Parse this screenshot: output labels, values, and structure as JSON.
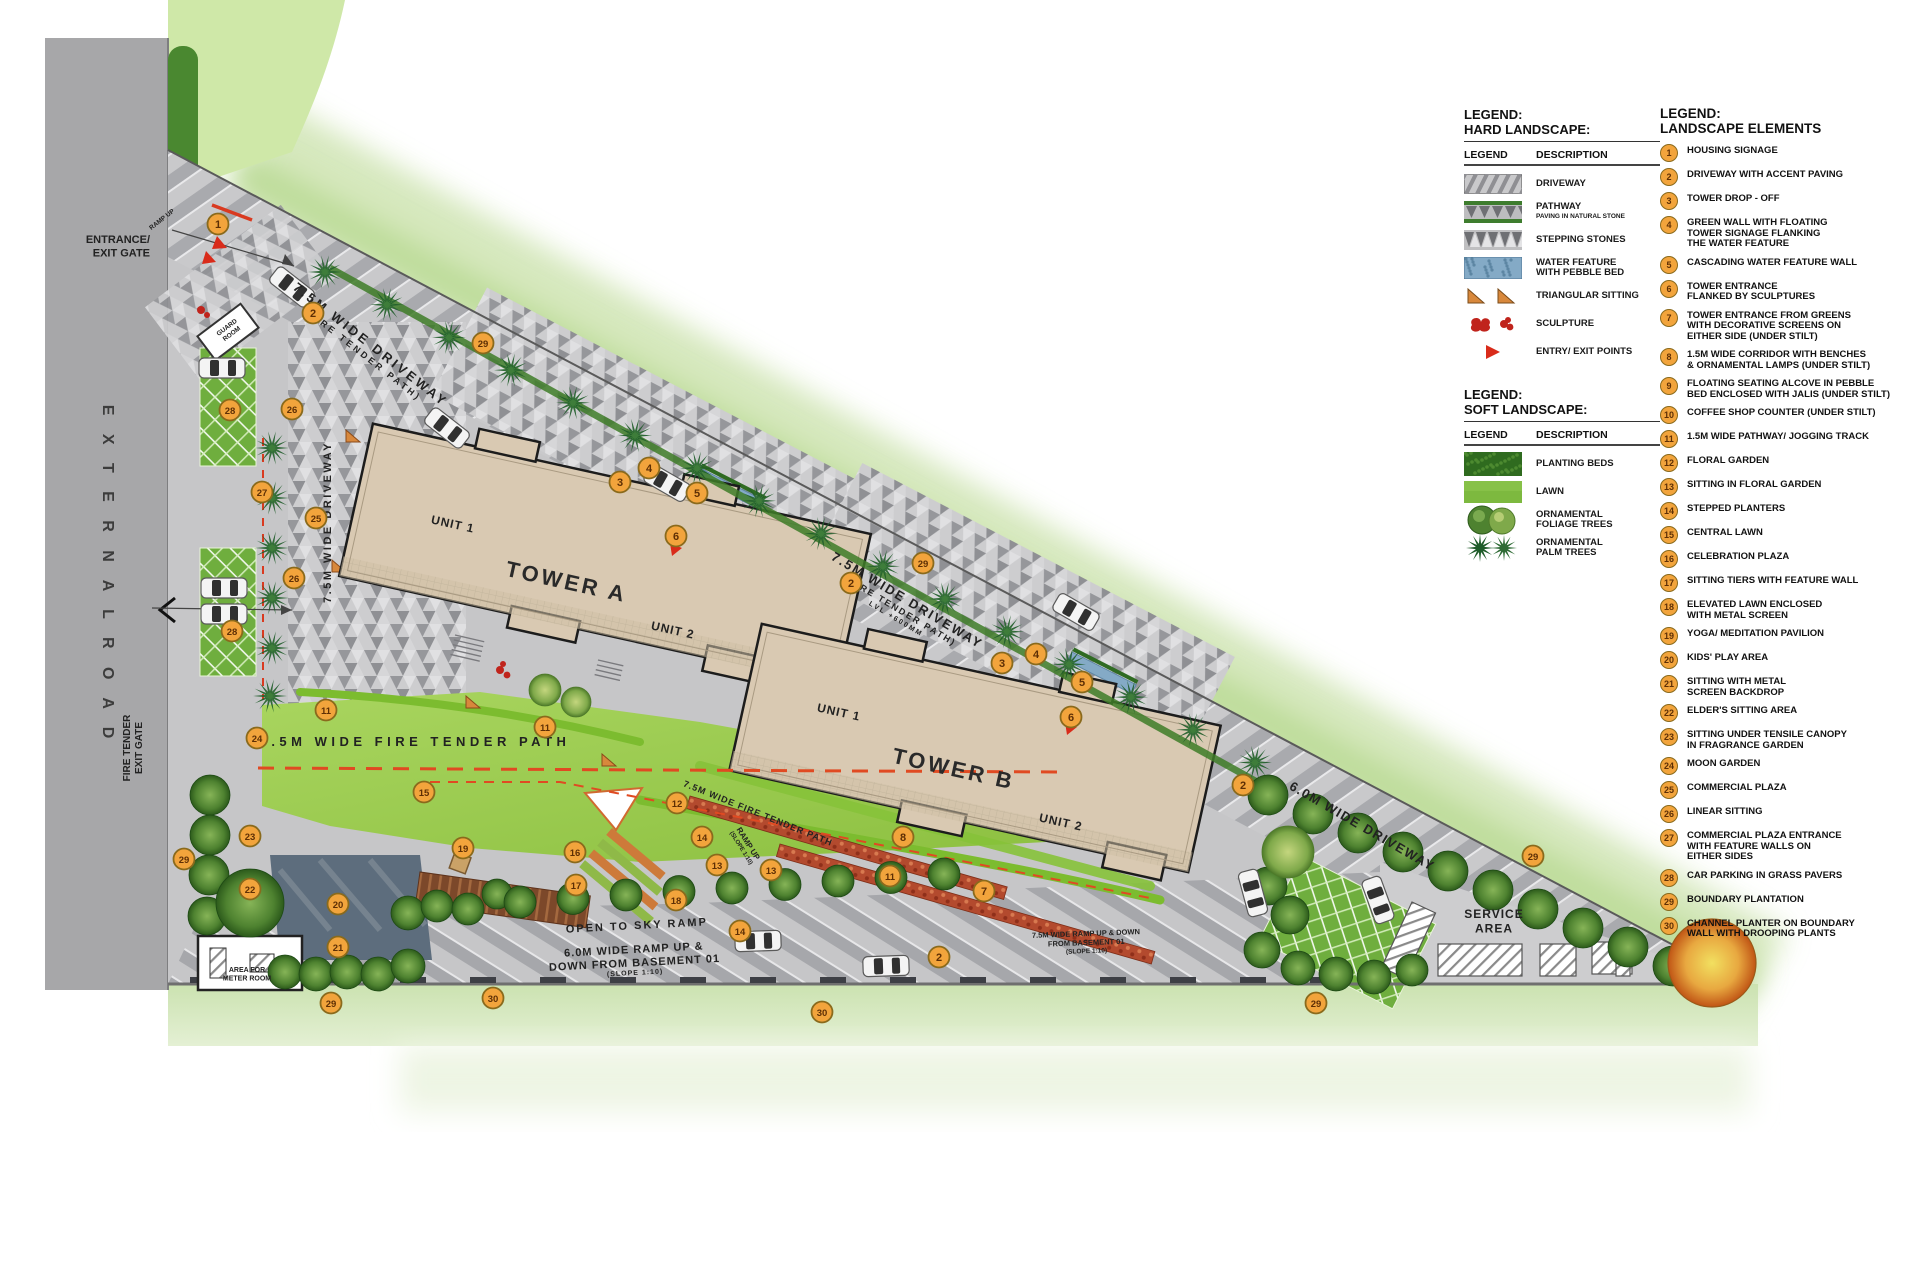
{
  "colors": {
    "marker_fill": "#F2A43C",
    "marker_stroke": "#8A6A1C",
    "marker_text": "#5E2F05",
    "tower_fill": "#D9C9B2",
    "lawn": "#9CC84F",
    "road_gray": "#A7A7A9",
    "accent_red": "#D93A20",
    "context_green": "#CFE4B2",
    "driveway_gray": "#C8C8CA"
  },
  "plan": {
    "markers": [
      [
        1,
        218,
        224
      ],
      [
        2,
        313,
        313
      ],
      [
        29,
        483,
        343
      ],
      [
        28,
        230,
        410
      ],
      [
        26,
        292,
        409
      ],
      [
        27,
        262,
        492
      ],
      [
        25,
        316,
        518
      ],
      [
        26,
        294,
        578
      ],
      [
        28,
        232,
        631
      ],
      [
        3,
        620,
        482
      ],
      [
        4,
        649,
        468
      ],
      [
        5,
        697,
        493
      ],
      [
        6,
        676,
        536
      ],
      [
        29,
        923,
        563
      ],
      [
        2,
        851,
        583
      ],
      [
        3,
        1002,
        663
      ],
      [
        4,
        1036,
        654
      ],
      [
        5,
        1082,
        682
      ],
      [
        6,
        1071,
        717
      ],
      [
        2,
        1243,
        785
      ],
      [
        29,
        1533,
        856
      ],
      [
        11,
        326,
        710
      ],
      [
        11,
        545,
        727
      ],
      [
        24,
        257,
        738
      ],
      [
        15,
        424,
        792
      ],
      [
        19,
        463,
        848
      ],
      [
        23,
        250,
        836
      ],
      [
        29,
        184,
        859
      ],
      [
        22,
        250,
        889
      ],
      [
        20,
        338,
        904
      ],
      [
        21,
        338,
        947
      ],
      [
        16,
        575,
        852
      ],
      [
        17,
        576,
        885
      ],
      [
        18,
        676,
        900
      ],
      [
        12,
        677,
        803
      ],
      [
        14,
        702,
        837
      ],
      [
        13,
        717,
        865
      ],
      [
        13,
        771,
        870
      ],
      [
        14,
        740,
        931
      ],
      [
        8,
        903,
        837
      ],
      [
        11,
        890,
        876
      ],
      [
        7,
        984,
        891
      ],
      [
        2,
        939,
        957
      ],
      [
        29,
        331,
        1003
      ],
      [
        30,
        493,
        998
      ],
      [
        30,
        822,
        1012
      ],
      [
        29,
        1316,
        1003
      ]
    ],
    "labels": [
      {
        "id": "external-road",
        "x": 103,
        "y": 575,
        "rot": 90,
        "ls": 7,
        "w": 600,
        "fill": "#3C3C3C",
        "lines": [
          {
            "t": "E X T E R N A L      R O A D",
            "s": 16
          }
        ]
      },
      {
        "id": "entrance-exit-gate",
        "x": 150,
        "y": 243,
        "rot": 0,
        "anchor": "end",
        "w": 700,
        "lines": [
          {
            "t": "ENTRANCE/",
            "s": 11
          },
          {
            "t": "EXIT GATE",
            "s": 11
          }
        ]
      },
      {
        "id": "fire-tender-exit-gate",
        "x": 130,
        "y": 748,
        "rot": -90,
        "w": 700,
        "lines": [
          {
            "t": "FIRE TENDER",
            "s": 10
          },
          {
            "t": "EXIT GATE",
            "s": 10
          }
        ]
      },
      {
        "id": "driveway-1",
        "x": 368,
        "y": 348,
        "rot": 38,
        "ls": 3,
        "w": 600,
        "lines": [
          {
            "t": "7.5M WIDE DRIVEWAY",
            "s": 13
          },
          {
            "t": "(FIRE TENDER PATH)",
            "s": 9
          }
        ]
      },
      {
        "id": "driveway-vertical",
        "x": 331,
        "y": 522,
        "rot": -90,
        "ls": 2.5,
        "w": 600,
        "lines": [
          {
            "t": "7.5M WIDE DRIVEWAY",
            "s": 11
          }
        ]
      },
      {
        "id": "driveway-2",
        "x": 905,
        "y": 604,
        "rot": 31,
        "ls": 2,
        "w": 600,
        "lines": [
          {
            "t": "7.5M WIDE DRIVEWAY",
            "s": 13
          },
          {
            "t": "(FIRE TENDER PATH)",
            "s": 9
          },
          {
            "t": "LVL +600MM",
            "s": 7
          }
        ]
      },
      {
        "id": "fire-tender-path",
        "x": 415,
        "y": 746,
        "rot": 0,
        "ls": 4.5,
        "w": 700,
        "lines": [
          {
            "t": "7.5M WIDE FIRE TENDER PATH",
            "s": 13
          }
        ]
      },
      {
        "id": "fire-tender-path-2",
        "x": 757,
        "y": 816,
        "rot": 22,
        "ls": 1,
        "w": 600,
        "lines": [
          {
            "t": "7.5M WIDE FIRE TENDER PATH",
            "s": 9
          }
        ]
      },
      {
        "id": "ramp-up",
        "x": 746,
        "y": 845,
        "rot": 58,
        "w": 600,
        "lines": [
          {
            "t": "RAMP UP",
            "s": 8
          },
          {
            "t": "(SLOPE 1:10)",
            "s": 6
          }
        ]
      },
      {
        "id": "open-to-sky-ramp",
        "x": 637,
        "y": 929,
        "rot": -3,
        "ls": 2,
        "w": 600,
        "lines": [
          {
            "t": "OPEN TO SKY RAMP",
            "s": 11
          }
        ]
      },
      {
        "id": "ramp-6m",
        "x": 634,
        "y": 953,
        "rot": -3,
        "ls": 1,
        "w": 700,
        "lines": [
          {
            "t": "6.0M WIDE RAMP UP &",
            "s": 11
          },
          {
            "t": "DOWN FROM BASEMENT 01",
            "s": 11
          },
          {
            "t": "(SLOPE 1:10)",
            "s": 7
          }
        ]
      },
      {
        "id": "ramp-75m",
        "x": 1086,
        "y": 936,
        "rot": -2,
        "w": 600,
        "lines": [
          {
            "t": "7.5M WIDE RAMP UP & DOWN",
            "s": 7.5
          },
          {
            "t": "FROM BASEMENT 01",
            "s": 7.5
          },
          {
            "t": "(SLOPE 1:10)",
            "s": 6.5
          }
        ]
      },
      {
        "id": "driveway-6m",
        "x": 1360,
        "y": 830,
        "rot": 30,
        "ls": 1.5,
        "w": 600,
        "lines": [
          {
            "t": "6.0M WIDE DRIVEWAY",
            "s": 13
          }
        ]
      },
      {
        "id": "service-area",
        "x": 1494,
        "y": 918,
        "ls": 1,
        "w": 600,
        "lines": [
          {
            "t": "SERVICE",
            "s": 12
          },
          {
            "t": "AREA",
            "s": 12
          }
        ]
      },
      {
        "id": "meter-room",
        "x": 247,
        "y": 972,
        "w": 700,
        "lines": [
          {
            "t": "AREA FOR",
            "s": 7
          },
          {
            "t": "METER ROOM",
            "s": 7
          }
        ]
      },
      {
        "id": "guard-room",
        "x": 228,
        "y": 329,
        "rot": -37,
        "w": 700,
        "lines": [
          {
            "t": "GUARD",
            "s": 6.5
          },
          {
            "t": "ROOM",
            "s": 6.5
          }
        ]
      },
      {
        "id": "ramp-up-entrance",
        "x": 163,
        "y": 221,
        "rot": -38,
        "w": 600,
        "lines": [
          {
            "t": "RAMP UP",
            "s": 6.5
          }
        ]
      },
      {
        "id": "tower-a",
        "x": 565,
        "y": 589,
        "rot": 12.5,
        "ls": 3,
        "w": 700,
        "fill": "#2A2A2A",
        "lines": [
          {
            "t": "TOWER A",
            "s": 22
          }
        ]
      },
      {
        "id": "tower-a-unit-1",
        "x": 452,
        "y": 528,
        "rot": 12.5,
        "ls": 1,
        "w": 600,
        "lines": [
          {
            "t": "UNIT 1",
            "s": 12
          }
        ]
      },
      {
        "id": "tower-a-unit-2",
        "x": 672,
        "y": 634,
        "rot": 12.5,
        "ls": 1,
        "w": 600,
        "lines": [
          {
            "t": "UNIT 2",
            "s": 12
          }
        ]
      },
      {
        "id": "tower-b",
        "x": 952,
        "y": 776,
        "rot": 12.5,
        "ls": 3,
        "w": 700,
        "fill": "#2A2A2A",
        "lines": [
          {
            "t": "TOWER B",
            "s": 22
          }
        ]
      },
      {
        "id": "tower-b-unit-1",
        "x": 838,
        "y": 716,
        "rot": 12.5,
        "ls": 1,
        "w": 600,
        "lines": [
          {
            "t": "UNIT 1",
            "s": 12
          }
        ]
      },
      {
        "id": "tower-b-unit-2",
        "x": 1060,
        "y": 826,
        "rot": 12.5,
        "ls": 1,
        "w": 600,
        "lines": [
          {
            "t": "UNIT 2",
            "s": 12
          }
        ]
      }
    ]
  },
  "legend_hard": {
    "title1": "LEGEND:",
    "title2": "HARD LANDSCAPE:",
    "col_legend": "LEGEND",
    "col_desc": "DESCRIPTION",
    "items": [
      {
        "type": "driveway",
        "label": "DRIVEWAY"
      },
      {
        "type": "pathway",
        "label": "PATHWAY",
        "sub": "PAVING IN NATURAL STONE"
      },
      {
        "type": "stepping",
        "label": "STEPPING STONES"
      },
      {
        "type": "water",
        "label": "WATER FEATURE",
        "label2": "WITH PEBBLE BED"
      },
      {
        "type": "triangular",
        "label": "TRIANGULAR SITTING"
      },
      {
        "type": "sculpture",
        "label": "SCULPTURE"
      },
      {
        "type": "entry",
        "label": "ENTRY/ EXIT POINTS"
      }
    ]
  },
  "legend_soft": {
    "title1": "LEGEND:",
    "title2": "SOFT LANDSCAPE:",
    "col_legend": "LEGEND",
    "col_desc": "DESCRIPTION",
    "items": [
      {
        "type": "planting",
        "label": "PLANTING BEDS"
      },
      {
        "type": "lawn",
        "label": "LAWN"
      },
      {
        "type": "foliage",
        "label": "ORNAMENTAL",
        "label2": "FOLIAGE TREES"
      },
      {
        "type": "palm",
        "label": "ORNAMENTAL",
        "label2": "PALM TREES"
      }
    ]
  },
  "legend_elements": {
    "title1": "LEGEND:",
    "title2": "LANDSCAPE ELEMENTS",
    "items": [
      {
        "num": 1,
        "lines": [
          "HOUSING SIGNAGE"
        ]
      },
      {
        "num": 2,
        "lines": [
          "DRIVEWAY WITH ACCENT PAVING"
        ]
      },
      {
        "num": 3,
        "lines": [
          "TOWER DROP - OFF"
        ]
      },
      {
        "num": 4,
        "lines": [
          "GREEN WALL WITH FLOATING",
          "TOWER SIGNAGE FLANKING",
          "THE WATER FEATURE"
        ]
      },
      {
        "num": 5,
        "lines": [
          "CASCADING WATER FEATURE WALL"
        ]
      },
      {
        "num": 6,
        "lines": [
          "TOWER ENTRANCE",
          "FLANKED BY SCULPTURES"
        ]
      },
      {
        "num": 7,
        "lines": [
          "TOWER ENTRANCE FROM GREENS",
          "WITH DECORATIVE SCREENS ON",
          "EITHER SIDE (UNDER STILT)"
        ]
      },
      {
        "num": 8,
        "lines": [
          "1.5M WIDE CORRIDOR WITH BENCHES",
          "& ORNAMENTAL LAMPS  (UNDER STILT)"
        ]
      },
      {
        "num": 9,
        "lines": [
          "FLOATING SEATING ALCOVE  IN PEBBLE",
          "BED ENCLOSED WITH JALIS (UNDER STILT)"
        ]
      },
      {
        "num": 10,
        "lines": [
          "COFFEE SHOP COUNTER (UNDER STILT)"
        ]
      },
      {
        "num": 11,
        "lines": [
          "1.5M WIDE PATHWAY/ JOGGING TRACK"
        ]
      },
      {
        "num": 12,
        "lines": [
          "FLORAL GARDEN"
        ]
      },
      {
        "num": 13,
        "lines": [
          "SITTING IN FLORAL GARDEN"
        ]
      },
      {
        "num": 14,
        "lines": [
          "STEPPED PLANTERS"
        ]
      },
      {
        "num": 15,
        "lines": [
          "CENTRAL LAWN"
        ]
      },
      {
        "num": 16,
        "lines": [
          "CELEBRATION PLAZA"
        ]
      },
      {
        "num": 17,
        "lines": [
          "SITTING TIERS WITH FEATURE WALL"
        ]
      },
      {
        "num": 18,
        "lines": [
          "ELEVATED LAWN ENCLOSED",
          "WITH METAL SCREEN"
        ]
      },
      {
        "num": 19,
        "lines": [
          "YOGA/ MEDITATION PAVILION"
        ]
      },
      {
        "num": 20,
        "lines": [
          "KIDS' PLAY AREA"
        ]
      },
      {
        "num": 21,
        "lines": [
          "SITTING WITH METAL",
          "SCREEN BACKDROP"
        ]
      },
      {
        "num": 22,
        "lines": [
          "ELDER'S SITTING AREA"
        ]
      },
      {
        "num": 23,
        "lines": [
          "SITTING UNDER TENSILE CANOPY",
          "IN FRAGRANCE GARDEN"
        ]
      },
      {
        "num": 24,
        "lines": [
          "MOON GARDEN"
        ]
      },
      {
        "num": 25,
        "lines": [
          "COMMERCIAL PLAZA"
        ]
      },
      {
        "num": 26,
        "lines": [
          "LINEAR SITTING"
        ]
      },
      {
        "num": 27,
        "lines": [
          "COMMERCIAL PLAZA ENTRANCE",
          "WITH FEATURE WALLS ON",
          "EITHER SIDES"
        ]
      },
      {
        "num": 28,
        "lines": [
          "CAR PARKING IN GRASS PAVERS"
        ]
      },
      {
        "num": 29,
        "lines": [
          "BOUNDARY PLANTATION"
        ]
      },
      {
        "num": 30,
        "lines": [
          "CHANNEL PLANTER ON BOUNDARY",
          "WALL WITH DROOPING PLANTS"
        ]
      }
    ]
  }
}
